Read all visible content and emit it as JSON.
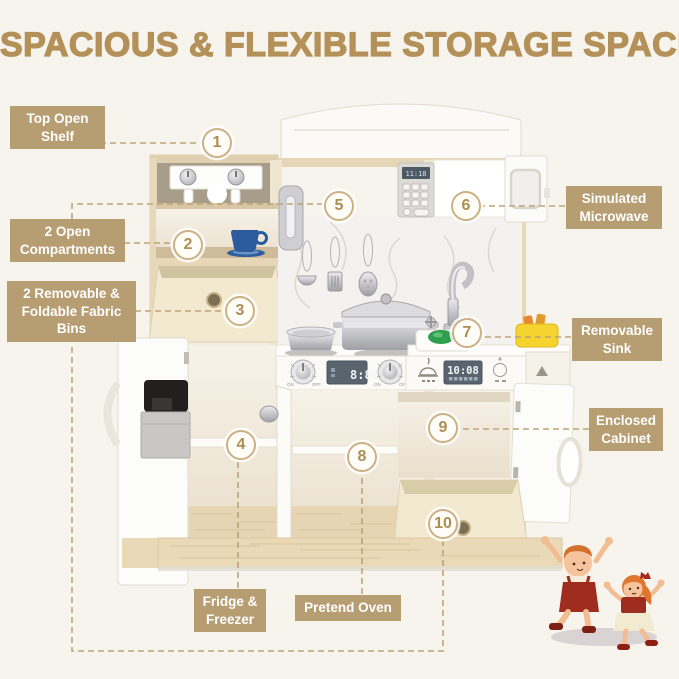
{
  "title": "SPACIOUS & FLEXIBLE STORAGE SPACE",
  "callout_labels": {
    "top_open_shelf": "Top Open Shelf",
    "open_compartments": "2 Open Compartments",
    "fabric_bins": "2 Removable & Foldable Fabric Bins",
    "simulated_microwave": "Simulated Microwave",
    "removable_sink": "Removable Sink",
    "enclosed_cabinet": "Enclosed Cabinet",
    "fridge_freezer": "Fridge & Freezer",
    "pretend_oven": "Pretend Oven"
  },
  "callouts": [
    "1",
    "2",
    "3",
    "4",
    "5",
    "6",
    "7",
    "8",
    "9",
    "10"
  ],
  "appliance_displays": {
    "microwave_clock": "11:18",
    "stove_clock": "8:88",
    "sink_clock": "10:08"
  },
  "knob_labels": {
    "on": "ON",
    "off": "OFF"
  },
  "colors": {
    "background": "#f7f4ed",
    "accent_title": "#b49159",
    "label_background": "#b79d72",
    "label_text": "#ffffff",
    "dashed_line": "#bda477",
    "callout_ring": "#cdb083",
    "callout_number": "#ae8d55",
    "wood": "#e6d5b3",
    "fabric_bin": "#f2e9d0",
    "teacup_blue": "#2b5b9c",
    "sink_green": "#2f9e4f",
    "toy_yellow": "#f5d42f",
    "kids_red": "#9e2d1f"
  }
}
